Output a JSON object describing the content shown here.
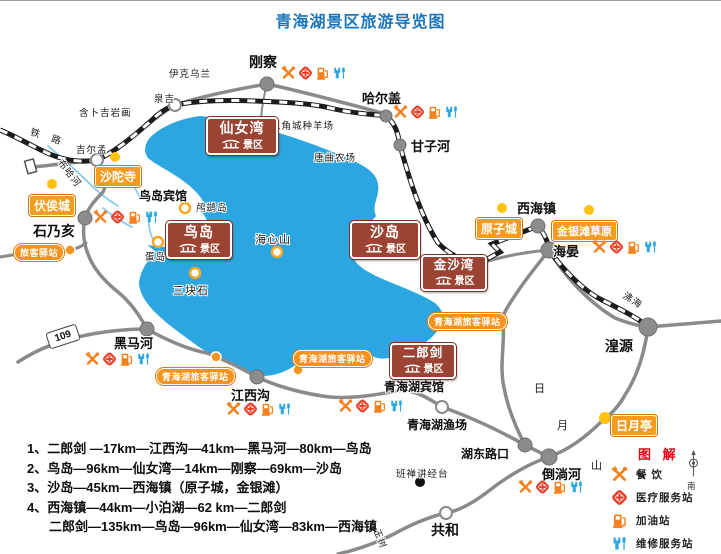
{
  "title": "青海湖景区旅游导览图",
  "towns": {
    "gangcha": "刚察",
    "haergai": "哈尔盖",
    "ganzihe": "甘子河",
    "xihaizhen": "西海镇",
    "haiyan": "海晏",
    "huangyuan": "湟源",
    "shinaihai": "石乃亥",
    "heimahe": "黑马河",
    "jiangxigou": "江西沟",
    "daotanghe": "倒淌河",
    "hudonglukou": "湖东路口",
    "gonghe": "共和"
  },
  "hotels": {
    "niaodao_hotel": "鸟岛宾馆",
    "qinghaihu_hotel": "青海湖宾馆",
    "yuchang": "青海湖渔场"
  },
  "scenic": {
    "xiannvwan": "仙女湾",
    "niaodao": "鸟岛",
    "shadao": "沙岛",
    "jinshawan": "金沙湾",
    "erlangjian": "二郎剑",
    "suffix": "景区"
  },
  "pois": {
    "fusicheng": "伏俟城",
    "shatuosi": "沙陀寺",
    "yuanzicheng": "原子城",
    "jinyintan": "金银滩草原",
    "riyueting": "日月亭"
  },
  "stations": {
    "short": "旅客驿站",
    "full": "青海湖旅客驿站"
  },
  "labels": {
    "yikewulan": "伊克乌兰",
    "quanji": "泉吉",
    "sanjiaocheng": "三角城种羊场",
    "tangqu": "唐曲农场",
    "hanbuji": "含卜吉岩画",
    "jiermeng": "吉尔孟",
    "tielu": "铁 路",
    "buhahe": "布哈河",
    "luciniao": "鸬鹚岛",
    "dandao": "蛋岛",
    "haixinshan": "海心山",
    "sankuaishi": "三块石",
    "feihai": "沸海",
    "banchan": "班禅讲经台",
    "ri": "日",
    "yue": "月",
    "shan": "山",
    "yushu": "玉树"
  },
  "road_sign": "109",
  "legend": {
    "title": "图 解",
    "compass_south": "南",
    "dining": "餐 饮",
    "medical": "医疗服务站",
    "fuel": "加油站",
    "repair": "维修服务站"
  },
  "routes": {
    "r1": "1、二郎剑 —17km—江西沟—41km—黑马河—80km—鸟岛",
    "r2": "2、鸟岛—96km—仙女湾—14km—刚察—69km—沙岛",
    "r3": "3、沙岛—45km—西海镇（原子城，金银滩）",
    "r4": "4、西海镇—44km—小泊湖—62 km—二郎剑",
    "r5": "二郎剑—135km—鸟岛—96km—仙女湾—83km—西海镇"
  },
  "colors": {
    "lake": "#2BA6E0",
    "orange": "#F6921E",
    "scenic_red": "#9C4433",
    "repair_blue": "#2CA9E1",
    "title_blue": "#1B75BC",
    "legend_red": "#E60012",
    "yellow_dot": "#FFC20E",
    "road_gray": "#8a8a8a"
  }
}
